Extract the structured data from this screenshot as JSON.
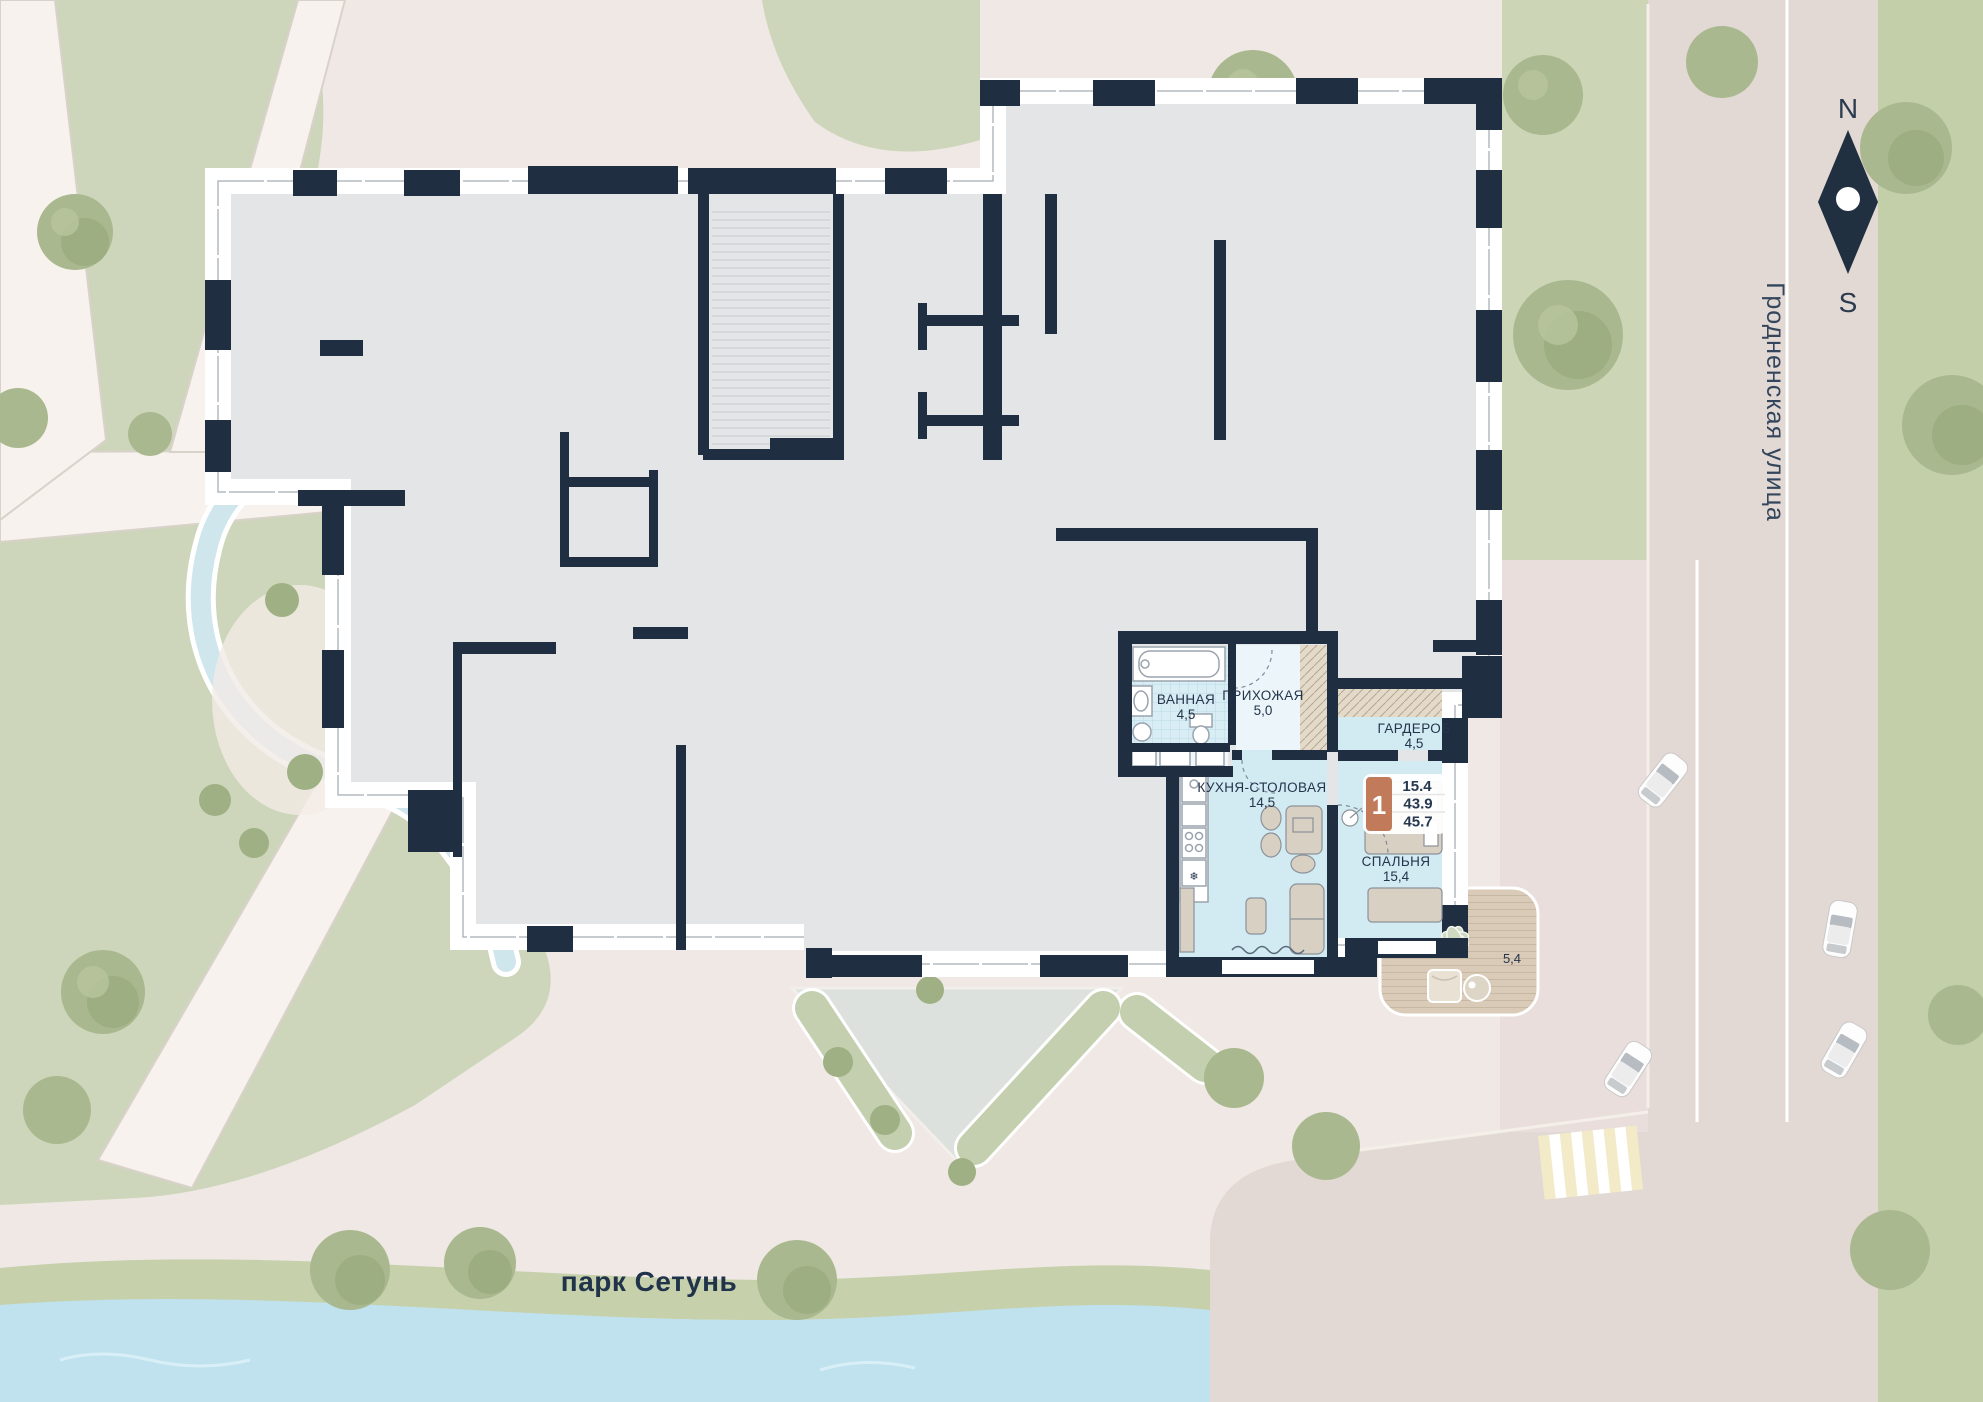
{
  "map": {
    "park_label": "парк Сетунь",
    "street_label": "Гродненская улица",
    "compass": {
      "north": "N",
      "south": "S"
    }
  },
  "apartment": {
    "badge": {
      "number": "1",
      "rows": [
        "15.4",
        "43.9",
        "45.7"
      ]
    },
    "rooms": [
      {
        "name": "ВАННАЯ",
        "area": "4,5"
      },
      {
        "name": "ПРИХОЖАЯ",
        "area": "5,0"
      },
      {
        "name": "ГАРДЕРОБ",
        "area": "4,5"
      },
      {
        "name": "КУХНЯ-СТОЛОВАЯ",
        "area": "14,5"
      },
      {
        "name": "СПАЛЬНЯ",
        "area": "15,4"
      }
    ],
    "terrace_area": "5,4"
  },
  "colors": {
    "wall": "#1f2e40",
    "unit_highlight": "#d2eaf2",
    "badge_accent": "#c17b5b",
    "park_green": "#cbd5b4",
    "river_blue": "#bfe2ee"
  }
}
